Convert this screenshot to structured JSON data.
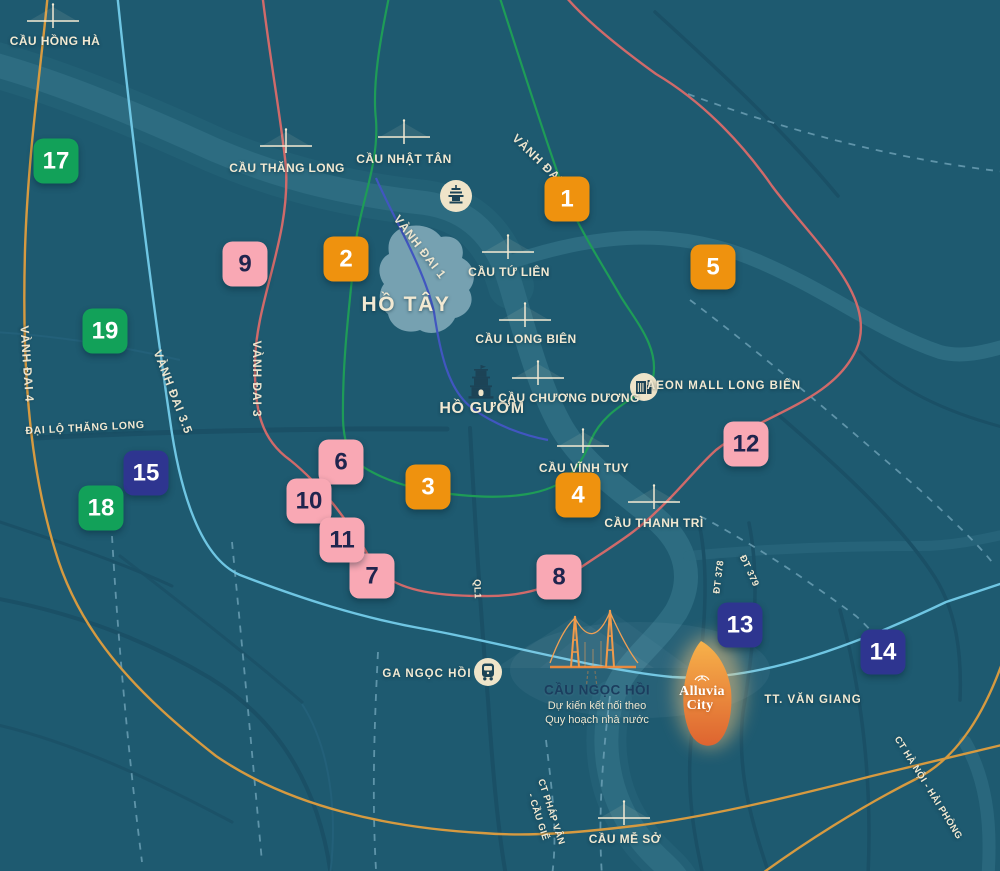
{
  "map": {
    "colors": {
      "background": "#1E5A70",
      "river": "#2D6C81",
      "lake": "#7FA9B8",
      "dark_road": "#1A5066",
      "thin_road": "#24607A",
      "dashed_road": "#6FA3B8",
      "ring_road_1": "#4156C0",
      "ring_road_2": "#1E9C57",
      "ring_road_3": "#D06A6A",
      "ring_road_3_5": "#6FC6E3",
      "ring_road_4": "#D69A40",
      "badge_orange": "#EF920E",
      "badge_pink": "#F9A8B4",
      "badge_green": "#12A159",
      "badge_navy": "#2E3590",
      "label_cream": "#F2E9D2",
      "note_title": "#1B3D5E",
      "icon_dark": "#1C4356",
      "icon_circle": "#EFE4C9",
      "project_orange": "#E98A3F"
    },
    "icons": {
      "bridge-icon": "bridge crossing marker (deck line with pylon)",
      "pagoda-icon": "pagoda silhouette in cream circle",
      "turtle-tower-icon": "turtle tower silhouette",
      "aeon-mall-icon": "mall building in cream circle",
      "train-station-icon": "train front in cream circle",
      "ngoc-hoi-bridge-icon": "orange suspension bridge illustration",
      "alluvia-logo-icon": "lotus brand mark above project name"
    },
    "badges": [
      {
        "n": "1",
        "c": "orange",
        "x": 567,
        "y": 199
      },
      {
        "n": "2",
        "c": "orange",
        "x": 346,
        "y": 259
      },
      {
        "n": "3",
        "c": "orange",
        "x": 428,
        "y": 487
      },
      {
        "n": "4",
        "c": "orange",
        "x": 578,
        "y": 495
      },
      {
        "n": "5",
        "c": "orange",
        "x": 713,
        "y": 267
      },
      {
        "n": "6",
        "c": "pink",
        "x": 341,
        "y": 462
      },
      {
        "n": "7",
        "c": "pink",
        "x": 372,
        "y": 576
      },
      {
        "n": "8",
        "c": "pink",
        "x": 559,
        "y": 577
      },
      {
        "n": "9",
        "c": "pink",
        "x": 245,
        "y": 264
      },
      {
        "n": "10",
        "c": "pink",
        "x": 309,
        "y": 501
      },
      {
        "n": "11",
        "c": "pink",
        "x": 342,
        "y": 540
      },
      {
        "n": "12",
        "c": "pink",
        "x": 746,
        "y": 444
      },
      {
        "n": "13",
        "c": "navy",
        "x": 740,
        "y": 625
      },
      {
        "n": "14",
        "c": "navy",
        "x": 883,
        "y": 652
      },
      {
        "n": "15",
        "c": "navy",
        "x": 146,
        "y": 473
      },
      {
        "n": "17",
        "c": "green",
        "x": 56,
        "y": 161
      },
      {
        "n": "18",
        "c": "green",
        "x": 101,
        "y": 508
      },
      {
        "n": "19",
        "c": "green",
        "x": 105,
        "y": 331
      }
    ],
    "bridges": [
      {
        "name": "cau-hong-ha",
        "text": "CẦU HỒNG HÀ",
        "lx": 55,
        "ly": 41,
        "ix": 53,
        "iy": 21
      },
      {
        "name": "cau-thang-long",
        "text": "CẦU THĂNG LONG",
        "lx": 287,
        "ly": 168,
        "ix": 286,
        "iy": 146
      },
      {
        "name": "cau-nhat-tan",
        "text": "CẦU NHẬT TÂN",
        "lx": 404,
        "ly": 159,
        "ix": 404,
        "iy": 137
      },
      {
        "name": "cau-tu-lien",
        "text": "CẦU TỨ LIÊN",
        "lx": 509,
        "ly": 272,
        "ix": 508,
        "iy": 252
      },
      {
        "name": "cau-long-bien",
        "text": "CẦU LONG BIÊN",
        "lx": 526,
        "ly": 339,
        "ix": 525,
        "iy": 320
      },
      {
        "name": "cau-chuong-duong",
        "text": "CẦU CHƯƠNG DƯƠNG",
        "lx": 569,
        "ly": 398,
        "ix": 538,
        "iy": 378
      },
      {
        "name": "cau-vinh-tuy",
        "text": "CẦU VĨNH TUY",
        "lx": 584,
        "ly": 468,
        "ix": 583,
        "iy": 446
      },
      {
        "name": "cau-thanh-tri",
        "text": "CẦU THANH TRÌ",
        "lx": 654,
        "ly": 523,
        "ix": 654,
        "iy": 502
      },
      {
        "name": "cau-me-so",
        "text": "CẦU MỄ SỞ",
        "lx": 625,
        "ly": 839,
        "ix": 624,
        "iy": 818
      }
    ],
    "labels": [
      {
        "name": "road-label-vanh-dai-4",
        "text": "VÀNH ĐAI 4",
        "x": 27,
        "y": 364,
        "rot": 86,
        "cls": "road"
      },
      {
        "name": "road-label-vanh-dai-3-5",
        "text": "VÀNH ĐAI 3.5",
        "x": 173,
        "y": 392,
        "rot": 69,
        "cls": "road"
      },
      {
        "name": "road-label-vanh-dai-3",
        "text": "VÀNH ĐAI 3",
        "x": 257,
        "y": 379,
        "rot": 90,
        "cls": "road"
      },
      {
        "name": "road-label-vanh-dai-1",
        "text": "VÀNH ĐAI 1",
        "x": 420,
        "y": 247,
        "rot": 52,
        "cls": "road"
      },
      {
        "name": "road-label-vanh-dai-2",
        "text": "VÀNH ĐAI 2",
        "x": 542,
        "y": 163,
        "rot": 44,
        "cls": "road"
      },
      {
        "name": "road-label-dai-lo-thang-long",
        "text": "ĐẠI LỘ THĂNG LONG",
        "x": 85,
        "y": 428,
        "rot": -3,
        "cls": "road-sm"
      },
      {
        "name": "road-label-ql1",
        "text": "QL1",
        "x": 477,
        "y": 589,
        "rot": 88,
        "cls": "road-xs"
      },
      {
        "name": "road-label-dt-378",
        "text": "ĐT 378",
        "x": 719,
        "y": 577,
        "rot": -83,
        "cls": "road-xs"
      },
      {
        "name": "road-label-dt-379",
        "text": "ĐT 379",
        "x": 749,
        "y": 571,
        "rot": 65,
        "cls": "road-xs"
      },
      {
        "name": "road-label-ct-phap-van",
        "text": "CT PHÁP VÂN",
        "x": 551,
        "y": 812,
        "rot": 72,
        "cls": "road-xs"
      },
      {
        "name": "road-label-cau-gie",
        "text": "- CẦU GIẼ",
        "x": 538,
        "y": 817,
        "rot": 72,
        "cls": "road-xs"
      },
      {
        "name": "road-label-ct-ha-noi-hai-phong",
        "text": "CT HÀ NỘI - HẢI PHÒNG",
        "x": 928,
        "y": 788,
        "rot": 58,
        "cls": "road-xs"
      },
      {
        "name": "place-label-ho-tay",
        "text": "HỒ TÂY",
        "x": 406,
        "y": 305,
        "rot": 0,
        "cls": "place-lg"
      },
      {
        "name": "place-label-ho-guom",
        "text": "HỒ GƯƠM",
        "x": 482,
        "y": 409,
        "rot": 0,
        "cls": "place-md"
      },
      {
        "name": "place-label-aeon-mall",
        "text": "AEON MALL LONG BIÊN",
        "x": 724,
        "y": 386,
        "rot": 0,
        "cls": "place-sm"
      },
      {
        "name": "place-label-ga-ngoc-hoi",
        "text": "GA NGỌC HỒI",
        "x": 427,
        "y": 674,
        "rot": 0,
        "cls": "place-sm"
      },
      {
        "name": "place-label-tt-van-giang",
        "text": "TT. VĂN GIANG",
        "x": 813,
        "y": 700,
        "rot": 0,
        "cls": "place-sm"
      },
      {
        "name": "note-cau-ngoc-hoi-title",
        "text": "CẦU NGỌC HỒI",
        "x": 597,
        "y": 690,
        "rot": 0,
        "cls": "note-title"
      },
      {
        "name": "note-cau-ngoc-hoi-line1",
        "text": "Dự kiến kết nối theo",
        "x": 597,
        "y": 706,
        "rot": 0,
        "cls": "note-sub"
      },
      {
        "name": "note-cau-ngoc-hoi-line2",
        "text": "Quy hoạch nhà nước",
        "x": 597,
        "y": 720,
        "rot": 0,
        "cls": "note-sub"
      },
      {
        "name": "brand-alluvia-line1",
        "text": "Alluvia",
        "x": 702,
        "y": 692,
        "rot": 0,
        "cls": "brand"
      },
      {
        "name": "brand-alluvia-line2",
        "text": "City",
        "x": 700,
        "y": 706,
        "rot": 0,
        "cls": "brand"
      }
    ]
  }
}
